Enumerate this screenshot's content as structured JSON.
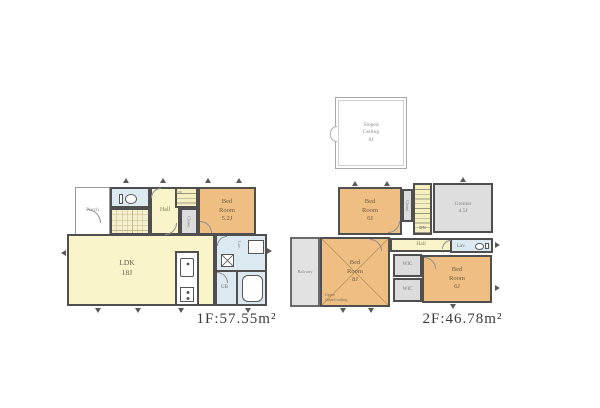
{
  "attic": {
    "label": "Sloped\nCeiling\n8J"
  },
  "floor1": {
    "caption": "1F:57.55m²",
    "porch": "Porch",
    "hall": "Hall",
    "up": "UP",
    "closet": "Closet",
    "bedroom": "Bed\nRoom\n5.2J",
    "ldk": "LDK\n18J",
    "washroom": "Lav.",
    "ub": "UB"
  },
  "floor2": {
    "caption": "2F:46.78m²",
    "bedroom_nw": "Bed\nRoom\n6J",
    "closet": "Closet",
    "dn": "DN",
    "grenier": "Grenier\n4.5J",
    "hall": "Hall",
    "lav": "Lav.",
    "bedroom_w": "Bed\nRoom\n8J",
    "sloped_note": "Upper\nsloped ceiling",
    "balcony": "Balcony",
    "wic_top": "WIC",
    "wic_bottom": "WIC",
    "bedroom_se": "Bed\nRoom\n6J"
  },
  "colors": {
    "wall": "#4f4f4f",
    "room_orange": "#efbe83",
    "room_yellow": "#f9f4c9",
    "room_blue": "#dde9f0",
    "room_gray": "#dcdcdc",
    "caption_text": "#3b3b3b"
  }
}
